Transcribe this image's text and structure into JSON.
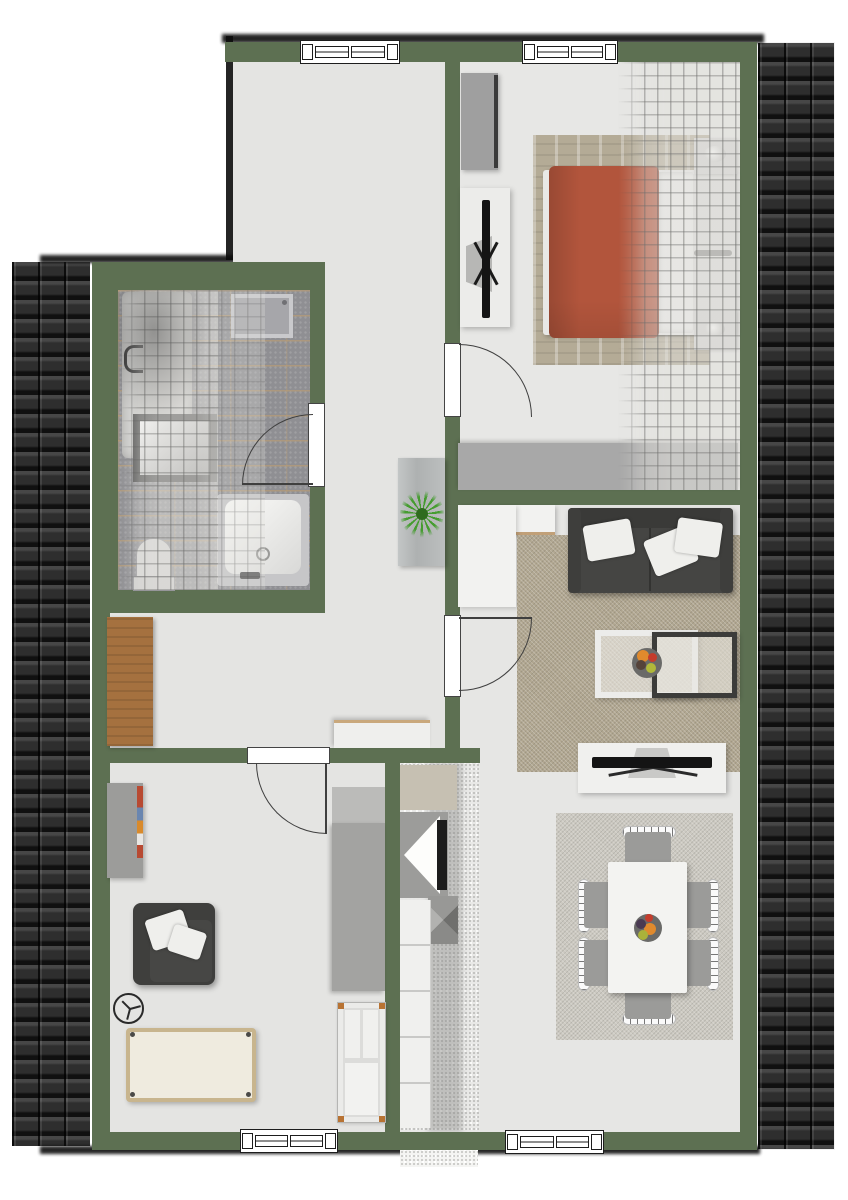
{
  "meta": {
    "title": "Attic apartment floor plan (top-down 3D render)",
    "text_labels": "none visible"
  },
  "palette": {
    "wall": "#5d7052",
    "roof-tile-dark": "#2d2d2d",
    "floor-light": "#e4e4e2",
    "floor-bedroom": "#e7e7e5",
    "bath-tile": "#8f8f93",
    "bath-grout": "#c4a06c",
    "rug-living": "#b1a791",
    "rug-dining": "#ccc9c1",
    "rug-bedroom": "#b4ab96",
    "duvet-terracotta": "#b2553c",
    "sofa-dark": "#454543",
    "wood-brown": "#a5713f",
    "accent-copper": "#b87333",
    "furniture-white": "#f0f0ee",
    "furniture-gray": "#a8a8a6",
    "plant-green": "#3f9b28"
  },
  "structure": {
    "exterior": [
      "roof-strip-left",
      "roof-strip-right",
      "drop-shadows"
    ],
    "windows": [
      "hallway-top-window",
      "bedroom-top-window",
      "kids-room-bottom-window",
      "dining-bottom-window"
    ],
    "doors": [
      "bedroom-door",
      "living-room-door",
      "bathroom-door",
      "kids-room-door"
    ]
  },
  "rooms": [
    {
      "name": "hallway",
      "items": [
        "console-table",
        "potted-plant",
        "wood-sideboard",
        "white-sideboard"
      ]
    },
    {
      "name": "bedroom",
      "items": [
        "wardrobe",
        "tv-stand",
        "tv",
        "knit-rug",
        "double-bed",
        "terracotta-duvet",
        "pillows",
        "nightstand-top",
        "nightstand-bottom",
        "lamps",
        "low-sideboard",
        "sloped-roof-overlay"
      ]
    },
    {
      "name": "bathroom",
      "items": [
        "bathtub-under-slope",
        "skylight-roof-window",
        "wall-sink",
        "toilet",
        "bathtub",
        "sloped-roof-overlay"
      ]
    },
    {
      "name": "living-room",
      "items": [
        "corner-sideboard",
        "sofa",
        "throw-pillows",
        "area-rug",
        "white-coffee-table",
        "dark-coffee-table",
        "fruit-bowl",
        "tv-board",
        "tv"
      ]
    },
    {
      "name": "dining-area",
      "items": [
        "area-rug",
        "dining-table",
        "six-chairs",
        "fruit-bowl"
      ]
    },
    {
      "name": "kids-room",
      "items": [
        "open-shelf",
        "armchair",
        "throw-pillows",
        "mobile-fan-symbol",
        "play-mat",
        "tall-cabinet",
        "crib"
      ]
    },
    {
      "name": "kitchen-strip",
      "items": [
        "tall-cabinet-beige",
        "appliance-with-black-front",
        "extractor-hood-pyramid",
        "counter-run",
        "speckled-tile-floor",
        "entrance-step"
      ]
    }
  ]
}
